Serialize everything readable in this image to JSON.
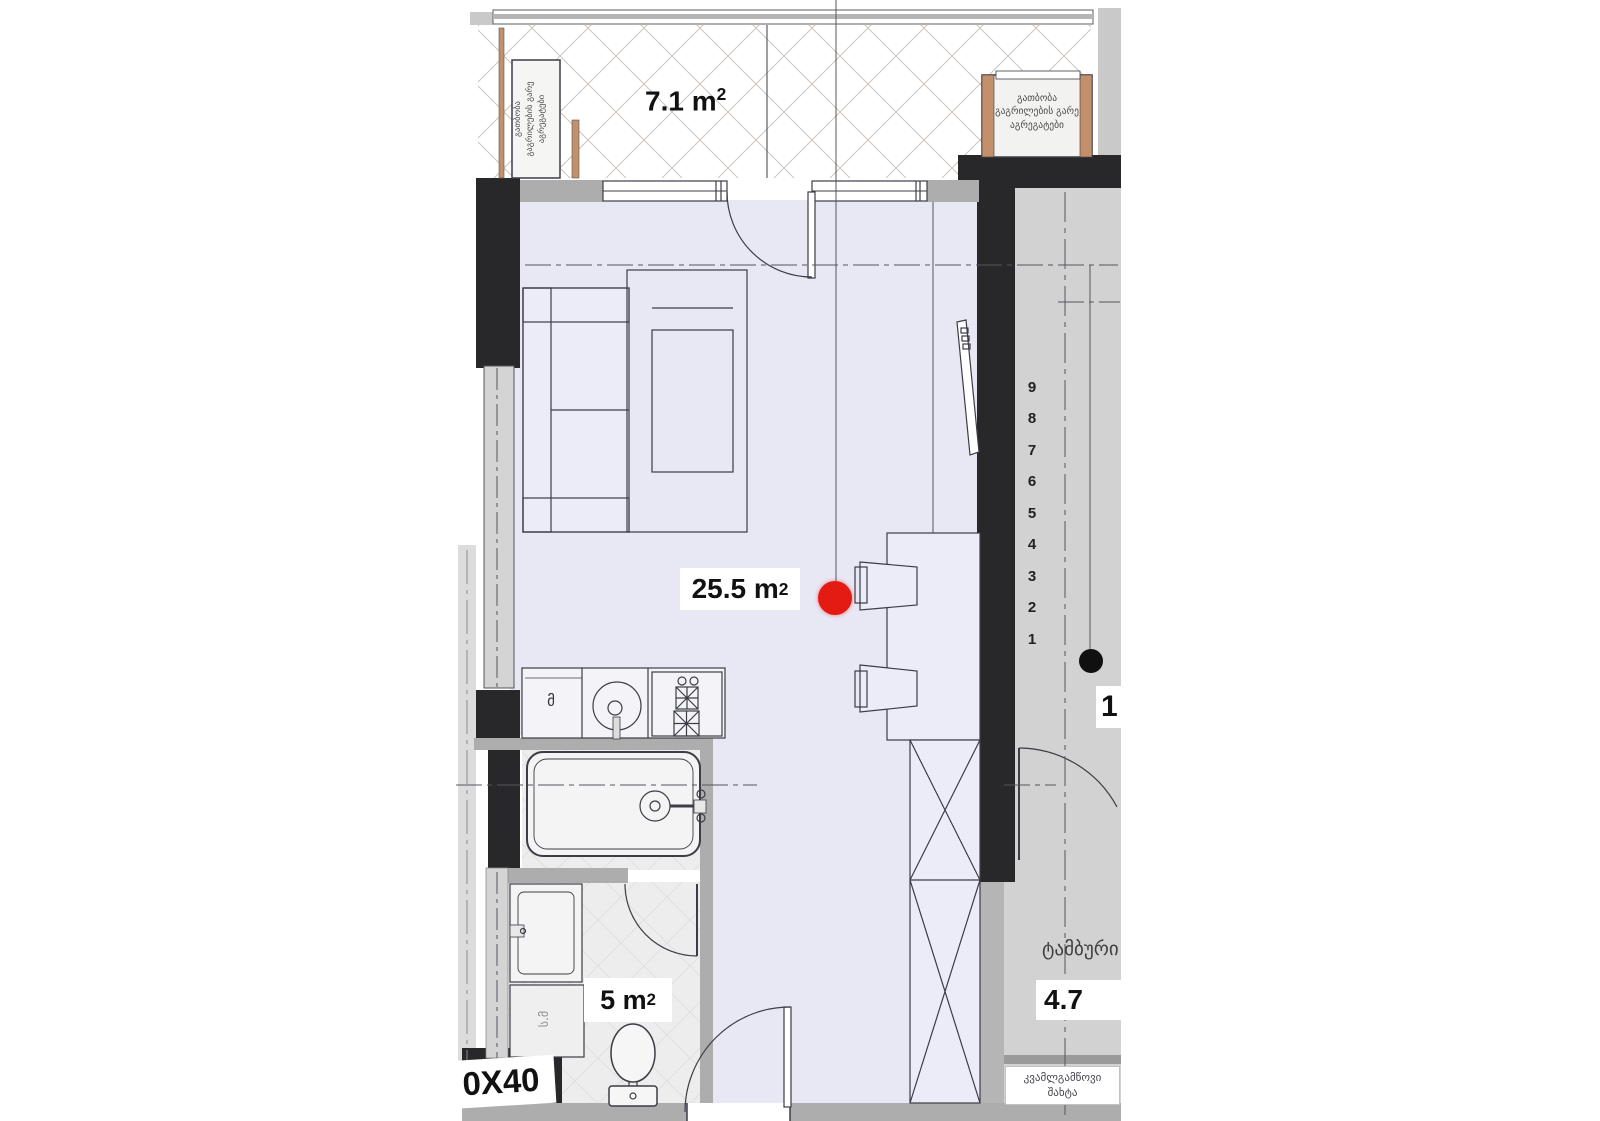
{
  "areas": {
    "balcony": {
      "num": "7.1 m",
      "sup": "2"
    },
    "living": {
      "num": "25.5 m",
      "sup": "2"
    },
    "bathroom": {
      "num": "5 m",
      "sup": "2"
    },
    "vestibule": "4.7"
  },
  "texts": {
    "ac_units_left": {
      "l1": "გათბობა",
      "l2": "გაგრილების გარე",
      "l3": "აგრეგატები"
    },
    "ac_units_right": {
      "l1": "გათბობა",
      "l2": "გაგრილების გარე",
      "l3": "აგრეგატები"
    },
    "vestibule_name": "ტამბური",
    "smoke_shaft": {
      "l1": "კვამლგამწოვი",
      "l2": "შახტა"
    },
    "fridge_mark": "მ",
    "washer_mark": "ს.მ",
    "column_size_note": "0X40",
    "floor_marker": "1"
  },
  "stairs": [
    "9",
    "8",
    "7",
    "6",
    "5",
    "4",
    "3",
    "2",
    "1"
  ],
  "colors": {
    "wall_black": "#28282a",
    "room_floor": "#e8e8f5",
    "wet_floor": "#ededed",
    "corridor_floor": "#d2d2d2",
    "sill_gray": "#adadad",
    "accent_tan": "#c2906a",
    "marker_red": "#e31b12",
    "marker_black": "#101010",
    "line": "#3c3c46"
  }
}
